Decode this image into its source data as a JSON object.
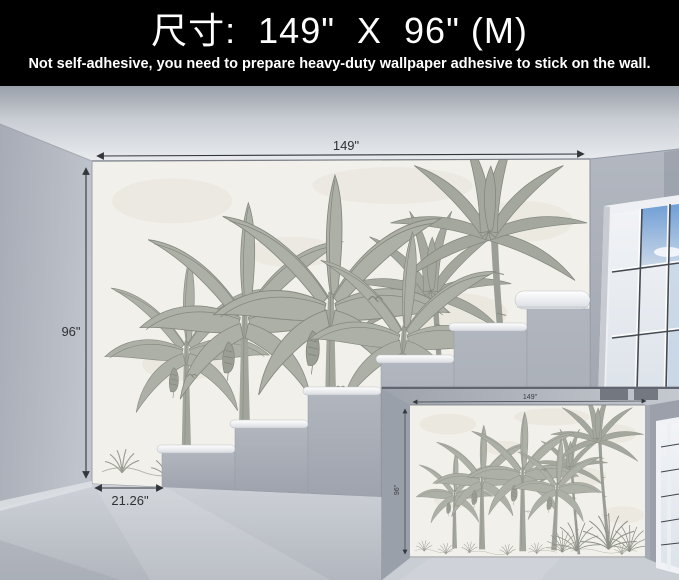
{
  "header": {
    "title": "尺寸:  149\"  X  96\" (M)",
    "subtitle": "Not self-adhesive, you need to prepare heavy-duty wallpaper adhesive to stick on the wall.",
    "background": "#000000",
    "text_color": "#ffffff"
  },
  "scene": {
    "description": "3D room mockup: grayscale tropical palm mural wallpaper on back wall, white staircase steps, window with blue sky at right",
    "width_label": "149\"",
    "height_label": "96\"",
    "panel_width_label": "21.26\"",
    "colors": {
      "wall_gray": "#aeb3bc",
      "wallpaper_background": "#f2f0ea",
      "mural_ink": "#8d9188",
      "sky_blue": "#6f9ed5",
      "floor_gray": "#c3c8cf",
      "dimension_text": "#2e3136"
    }
  },
  "inset": {
    "description": "Small flat preview photo of the same mural wall with window",
    "width_label": "149\"",
    "height_label": "96\""
  }
}
